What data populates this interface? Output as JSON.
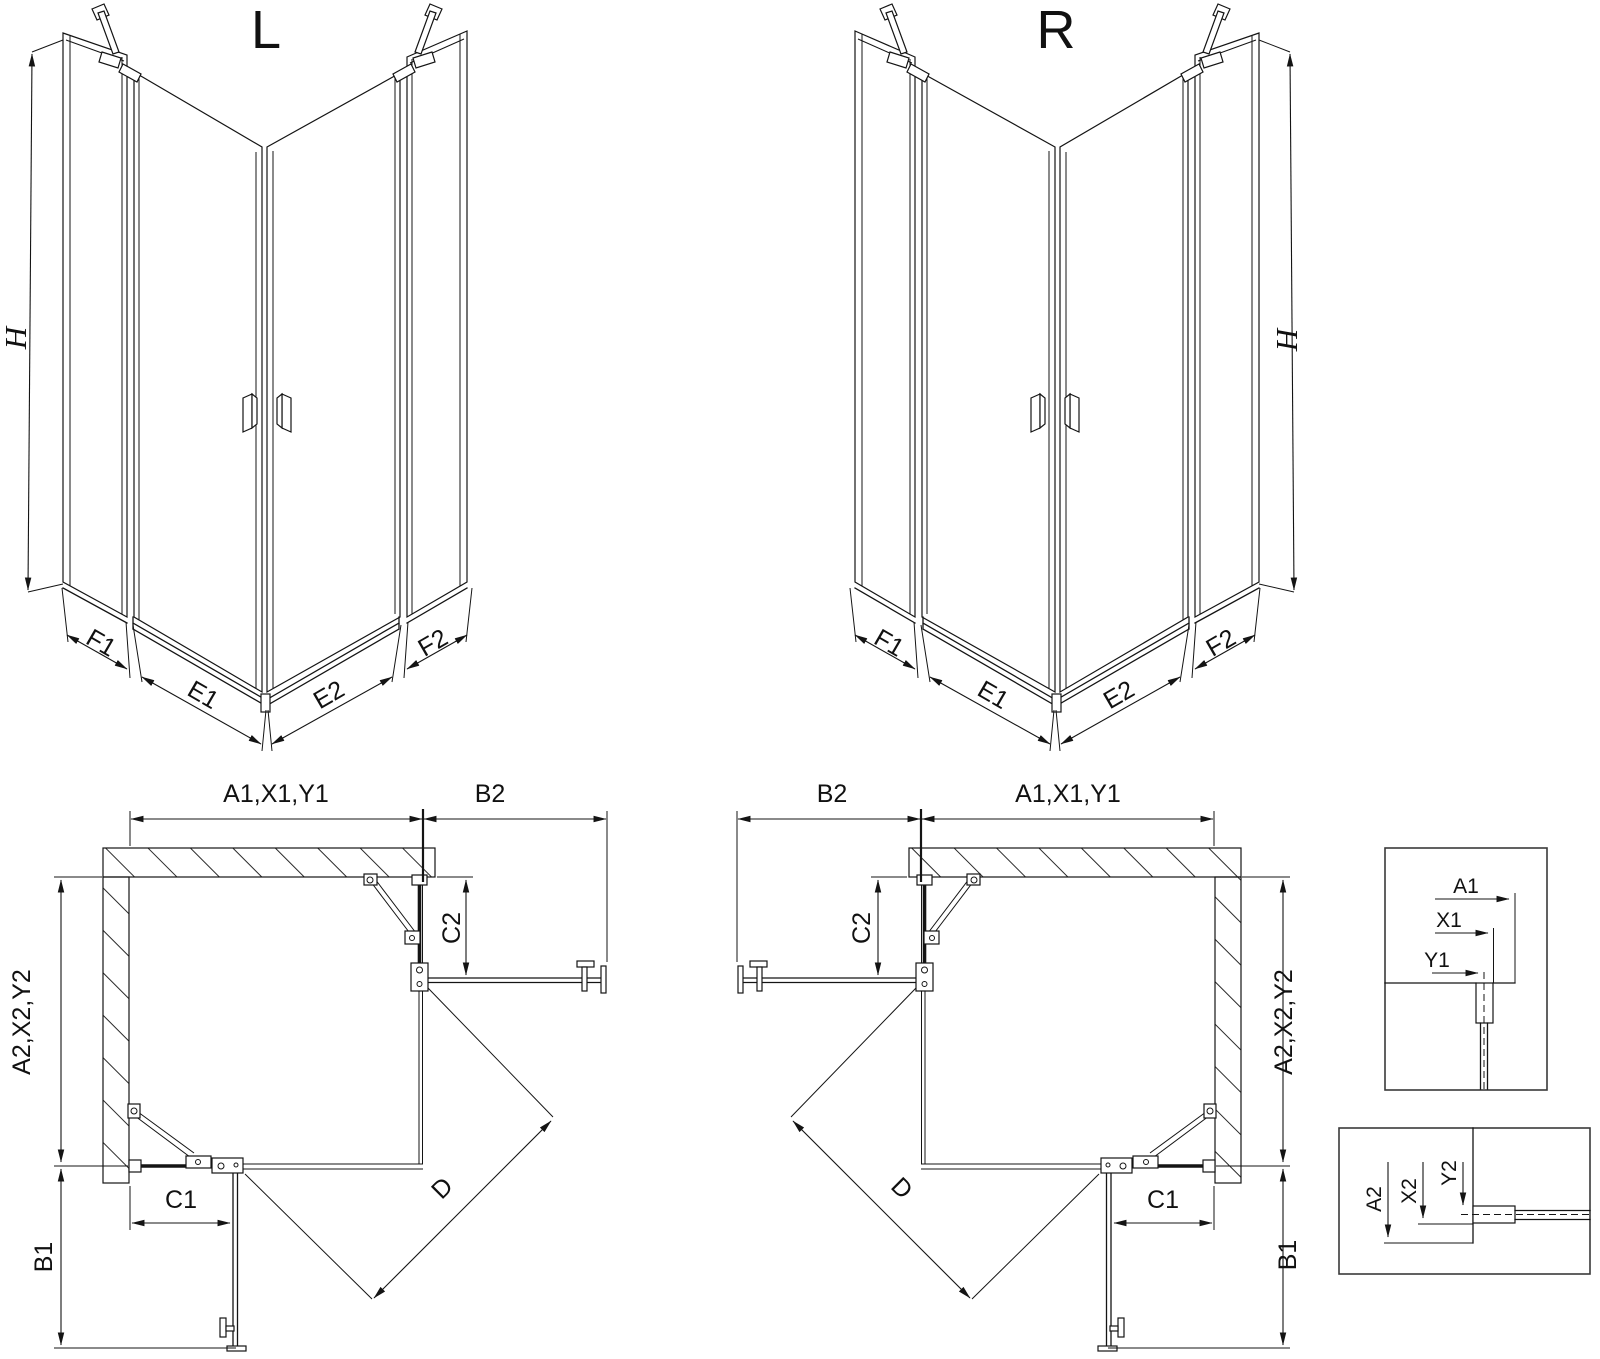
{
  "drawing": {
    "iso_l": {
      "title": "L",
      "h": "H",
      "f1": "F1",
      "e1": "E1",
      "e2": "E2",
      "f2": "F2"
    },
    "iso_r": {
      "title": "R",
      "h": "H",
      "f1": "F1",
      "e1": "E1",
      "e2": "E2",
      "f2": "F2"
    },
    "plan_l": {
      "a1": "A1,X1,Y1",
      "b2": "B2",
      "c2": "C2",
      "a2": "A2,X2,Y2",
      "c1": "C1",
      "b1": "B1",
      "d": "D"
    },
    "plan_r": {
      "a1": "A1,X1,Y1",
      "b2": "B2",
      "c2": "C2",
      "a2": "A2,X2,Y2",
      "c1": "C1",
      "b1": "B1",
      "d": "D"
    },
    "detail_1": {
      "a1": "A1",
      "x1": "X1",
      "y1": "Y1"
    },
    "detail_2": {
      "a2": "A2",
      "x2": "X2",
      "y2": "Y2"
    }
  },
  "colors": {
    "line": "#141414",
    "background": "#ffffff"
  }
}
